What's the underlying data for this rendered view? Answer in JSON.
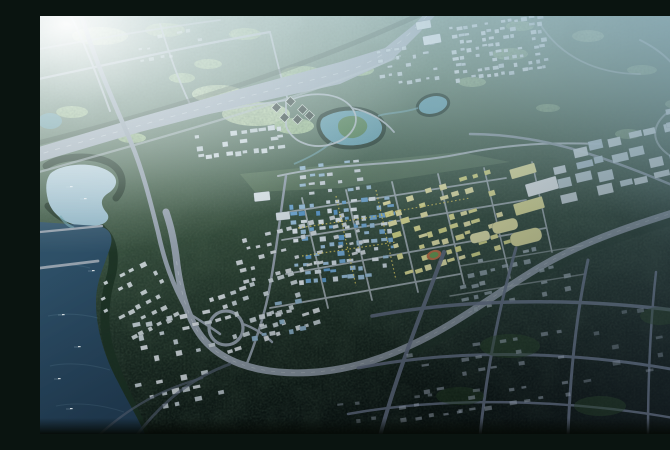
{
  "meta": {
    "title": "Aerial bird's-eye 3D rendering of an urban master plan",
    "description": "Daytime-to-dusk aerial rendering of a planned city: sun glare over forested hills at top left, a wide expressway crossing diagonally, a lake and river along the west, a dense downtown of white and blue-glass buildings with yellow development parcels and a stadium at the center, a loop interchange on the ring arterial, industrial grids to the east, and a darkened tree-grid district in the southeast."
  },
  "colors": {
    "glare": "#f2f7f8",
    "haze-top": "#cfe2e8",
    "haze-blue": "#7ca2b6",
    "base-top": "#8fae9b",
    "base-mid": "#44604b",
    "base-low": "#1e3026",
    "base-dark": "#0a1410",
    "speckle": "#142417",
    "meadow": "#a9c795",
    "meadow-light": "#c0d6a8",
    "water-light": "#b0cbd7",
    "water-mid": "#7fa9bc",
    "water-dark": "#30536a",
    "water-deep": "#24415a",
    "pond-teal": "#5f9aa8",
    "island-green": "#4e7c4b",
    "road-light": "#b3bdc5",
    "road-mid": "#94a0ac",
    "road-dark": "#4c5566",
    "expressway": "#a0acb7",
    "yellow-parcel": "#e6e494",
    "yellow-tree": "#d8c75b",
    "stadium-track": "#bf6a3e",
    "stadium-field": "#649a4b",
    "tree-fringe": "#1d3325",
    "boat": "#eef3f5"
  },
  "scene": {
    "regions": {
      "forest_north": "Forested hills with country roads",
      "expressway": "Wide diagonal expressway",
      "lake_west": "West lake with boats",
      "river_southwest": "Southwest river",
      "island_pond": "Pond with green island",
      "pond_ne": "Small teal pond",
      "city_core": "Downtown core with blue-glass towers and tree-lined streets",
      "yellow_parcels": "Yellow planned development parcels",
      "stadium": "Stadium with running track",
      "interchange": "Loop interchange on ring arterial",
      "industrial_east": "Eastern industrial building grid",
      "dark_southeast": "Dusk-darkened southeast tree-grid district"
    },
    "stadium": {
      "cx": 394,
      "cy": 239,
      "rot": -16
    },
    "interchange": {
      "cx": 186,
      "cy": 312,
      "r": 17
    },
    "clusters": [
      {
        "id": "town-north",
        "x": 413,
        "y": 5,
        "w": 95,
        "h": 58,
        "cols": 13,
        "rows": 8,
        "bw": 5,
        "bh": 3.4,
        "rot": -8,
        "p": 0.7,
        "op": 0.9,
        "fills": [
          "#d4dee3",
          "#c7d3d9",
          "#dde5e9"
        ]
      },
      {
        "id": "town-north-west",
        "x": 338,
        "y": 30,
        "w": 64,
        "h": 42,
        "cols": 7,
        "rows": 5,
        "bw": 4.6,
        "bh": 3.2,
        "rot": -8,
        "p": 0.5,
        "op": 0.85,
        "fills": [
          "#ccd8de"
        ]
      },
      {
        "id": "grid-mid-left",
        "x": 156,
        "y": 114,
        "w": 92,
        "h": 30,
        "cols": 10,
        "rows": 3,
        "bw": 6,
        "bh": 4,
        "rot": -7,
        "p": 0.8,
        "op": 0.95,
        "fills": [
          "#cdd7db",
          "#dbe3e7"
        ]
      },
      {
        "id": "hamlet-northwest",
        "x": 98,
        "y": 16,
        "w": 72,
        "h": 32,
        "cols": 7,
        "rows": 3,
        "bw": 4.4,
        "bh": 3,
        "rot": -10,
        "p": 0.45,
        "op": 0.6,
        "fills": [
          "#d9e3e7"
        ]
      },
      {
        "id": "industrial-east",
        "x": 518,
        "y": 120,
        "w": 132,
        "h": 58,
        "cols": 7,
        "rows": 4,
        "bw": 13,
        "bh": 8,
        "rot": -13,
        "p": 0.85,
        "op": 0.95,
        "fills": [
          "#c9d8e0",
          "#b9cdd8",
          "#d6e1e6"
        ]
      },
      {
        "id": "right-edge-buildings",
        "x": 628,
        "y": 90,
        "w": 36,
        "h": 28,
        "cols": 3,
        "rows": 2,
        "bw": 8,
        "bh": 6,
        "rot": -12,
        "p": 0.95,
        "op": 0.9,
        "fills": [
          "#ced9de"
        ]
      },
      {
        "id": "cbd-core",
        "x": 254,
        "y": 184,
        "w": 104,
        "h": 84,
        "cols": 12,
        "rows": 10,
        "bw": 5.6,
        "bh": 4,
        "rot": -5,
        "p": 0.68,
        "op": 1,
        "fills": [
          "#74acd8",
          "#e2eaef",
          "#9cc2dd",
          "#d4dfe6",
          "#5d9bcd"
        ]
      },
      {
        "id": "north-of-cbd",
        "x": 260,
        "y": 146,
        "w": 74,
        "h": 36,
        "cols": 8,
        "rows": 4,
        "bw": 5,
        "bh": 3.5,
        "rot": -6,
        "p": 0.6,
        "op": 0.95,
        "fills": [
          "#d7dfe4",
          "#a3c6de"
        ]
      },
      {
        "id": "yellow-parcel-wedge",
        "x": 352,
        "y": 168,
        "w": 116,
        "h": 84,
        "cols": 10,
        "rows": 8,
        "bw": 7,
        "bh": 4.6,
        "rot": -17,
        "p": 0.58,
        "op": 1,
        "fills": [
          "#e6e494",
          "#ede9a9",
          "#dcdd86"
        ]
      },
      {
        "id": "residential-west",
        "x": 176,
        "y": 264,
        "w": 104,
        "h": 66,
        "cols": 10,
        "rows": 6,
        "bw": 5.6,
        "bh": 4,
        "rot": -18,
        "p": 0.55,
        "op": 0.95,
        "fills": [
          "#dfe6ea",
          "#cdd8dd"
        ]
      },
      {
        "id": "residential-mid",
        "x": 196,
        "y": 208,
        "w": 134,
        "h": 50,
        "cols": 12,
        "rows": 5,
        "bw": 5.2,
        "bh": 3.6,
        "rot": -14,
        "p": 0.55,
        "op": 0.95,
        "fills": [
          "#d6dee2"
        ]
      },
      {
        "id": "residential-southwest",
        "x": 66,
        "y": 252,
        "w": 70,
        "h": 72,
        "cols": 7,
        "rows": 6,
        "bw": 5.2,
        "bh": 4,
        "rot": -27,
        "p": 0.5,
        "op": 0.9,
        "fills": [
          "#d9e1e5"
        ]
      },
      {
        "id": "residential-bottom",
        "x": 92,
        "y": 300,
        "w": 90,
        "h": 96,
        "cols": 8,
        "rows": 8,
        "bw": 6,
        "bh": 4.4,
        "rot": -12,
        "p": 0.55,
        "op": 0.95,
        "fills": [
          "#dee5e9",
          "#cbd6dc"
        ]
      },
      {
        "id": "cluster-near-interchange",
        "x": 210,
        "y": 286,
        "w": 56,
        "h": 38,
        "cols": 6,
        "rows": 4,
        "bw": 5.6,
        "bh": 4,
        "rot": -10,
        "p": 0.6,
        "op": 0.95,
        "fills": [
          "#d6dfe4",
          "#93b9d3"
        ]
      },
      {
        "id": "residential-se-dim",
        "x": 418,
        "y": 236,
        "w": 116,
        "h": 56,
        "cols": 10,
        "rows": 5,
        "bw": 6,
        "bh": 4,
        "rot": -12,
        "p": 0.5,
        "op": 0.8,
        "fills": [
          "#b3c1ca",
          "#a5b4be"
        ]
      },
      {
        "id": "dark-district-a",
        "dark": true,
        "x": 356,
        "y": 326,
        "w": 180,
        "h": 76,
        "cols": 13,
        "rows": 6,
        "bw": 6,
        "bh": 3.4,
        "rot": -9,
        "p": 0.4,
        "op": 0.5,
        "fills": [
          "#8d96a5"
        ]
      },
      {
        "id": "dark-district-b",
        "dark": true,
        "x": 540,
        "y": 292,
        "w": 124,
        "h": 78,
        "cols": 8,
        "rows": 5,
        "bw": 6.4,
        "bh": 3.6,
        "rot": -10,
        "p": 0.32,
        "op": 0.42,
        "fills": [
          "#7e8795"
        ]
      },
      {
        "id": "dark-district-c",
        "dark": true,
        "x": 300,
        "y": 380,
        "w": 150,
        "h": 34,
        "cols": 10,
        "rows": 2,
        "bw": 5.6,
        "bh": 3.2,
        "rot": -6,
        "p": 0.35,
        "op": 0.45,
        "fills": [
          "#848d9b"
        ]
      }
    ],
    "big_buildings": [
      {
        "id": "hall-nw-1",
        "x": 376,
        "y": 5,
        "w": 15,
        "h": 8,
        "fill": "#e4ebee",
        "rot": -10
      },
      {
        "id": "hall-nw-2",
        "x": 383,
        "y": 19,
        "w": 18,
        "h": 9,
        "fill": "#e8eef1",
        "rot": -10
      },
      {
        "id": "expo-white-hall",
        "x": 486,
        "y": 164,
        "w": 32,
        "h": 13,
        "fill": "#eef3f5",
        "rot": -16
      },
      {
        "id": "yellow-hall-1",
        "x": 470,
        "y": 150,
        "w": 26,
        "h": 10,
        "fill": "#e9e7a2",
        "rot": -16
      },
      {
        "id": "yellow-hall-2",
        "x": 474,
        "y": 184,
        "w": 30,
        "h": 12,
        "fill": "#e6e49a",
        "rot": -16
      },
      {
        "id": "yellow-dome-1",
        "x": 452,
        "y": 204,
        "w": 26,
        "h": 12,
        "fill": "#eae7a4",
        "rot": -14,
        "rx": 5
      },
      {
        "id": "yellow-dome-2",
        "x": 470,
        "y": 214,
        "w": 32,
        "h": 14,
        "fill": "#e6e39c",
        "rot": -14,
        "rx": 6
      },
      {
        "id": "yellow-dome-3",
        "x": 430,
        "y": 216,
        "w": 20,
        "h": 10,
        "fill": "#ece9ad",
        "rot": -14,
        "rx": 4
      },
      {
        "id": "east-slab",
        "x": 636,
        "y": 190,
        "w": 30,
        "h": 9,
        "fill": "#e2e9ed",
        "rot": -8
      },
      {
        "id": "civic-block-1",
        "x": 214,
        "y": 176,
        "w": 16,
        "h": 9,
        "fill": "#dfe7eb",
        "rot": -6
      },
      {
        "id": "civic-block-2",
        "x": 236,
        "y": 196,
        "w": 14,
        "h": 8,
        "fill": "#d9e2e7",
        "rot": -6
      }
    ],
    "dark_roof_pavilions": [
      {
        "x": 233,
        "y": 88
      },
      {
        "x": 247,
        "y": 82
      },
      {
        "x": 259,
        "y": 90
      },
      {
        "x": 241,
        "y": 98
      },
      {
        "x": 254,
        "y": 100
      },
      {
        "x": 266,
        "y": 96
      }
    ],
    "boats": [
      {
        "x": 30,
        "y": 170
      },
      {
        "x": 44,
        "y": 182
      },
      {
        "x": 22,
        "y": 298
      },
      {
        "x": 38,
        "y": 330
      },
      {
        "x": 18,
        "y": 362
      },
      {
        "x": 52,
        "y": 254
      },
      {
        "x": 30,
        "y": 392
      }
    ]
  }
}
